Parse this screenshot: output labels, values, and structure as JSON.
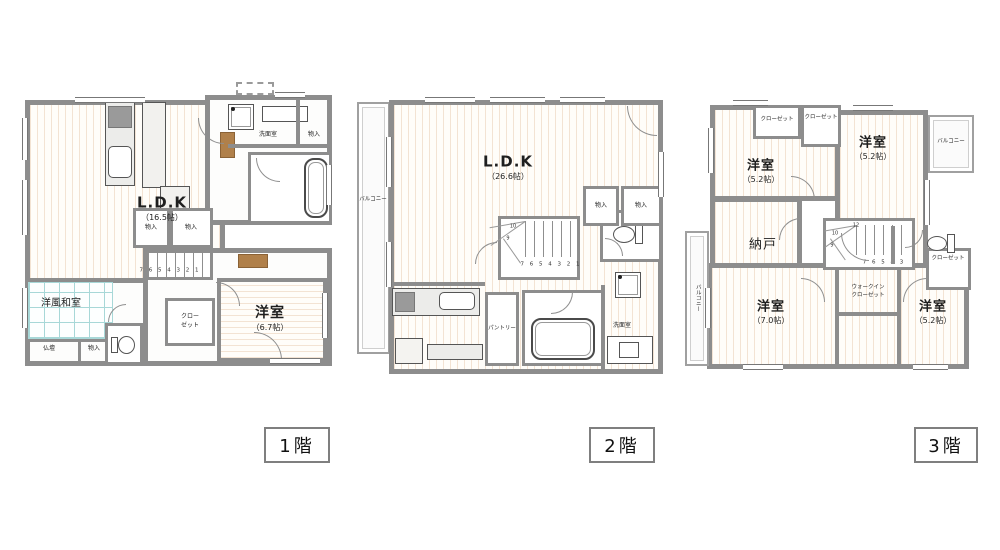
{
  "colors": {
    "wall": "#8d8d8d",
    "floor_line": "#f3e3d3",
    "tatami_line": "#a8d8d8",
    "wood": "#b0804a",
    "fixture": "#555555",
    "balcony_border": "#a0a0a0",
    "text": "#1f1f1f",
    "tag_border": "#7f7f7f"
  },
  "floor1": {
    "tag": "1階",
    "ldk": "L.D.K",
    "ldk_size": "（16.5帖）",
    "storage_a": "物入",
    "storage_b": "物入",
    "storage_c": "物入",
    "storage_d": "物入",
    "washroom": "洗面室",
    "japanese_room": "洋風和室",
    "butsudan": "仏壇",
    "closet_line1": "クロー",
    "closet_line2": "ゼット",
    "bedroom": "洋室",
    "bedroom_size": "（6.7帖）",
    "stairs_run": "7 6 5 4 3 2 1"
  },
  "floor2": {
    "tag": "2階",
    "ldk": "L.D.K",
    "ldk_size": "（26.6帖）",
    "balcony": "バルコニー",
    "storage_a": "物入",
    "storage_b": "物入",
    "pantry": "パントリー",
    "washroom": "洗面室",
    "stairs_run": "7 6 5 4 3 2 1",
    "stairs_n10": "10",
    "stairs_n9": "9"
  },
  "floor3": {
    "tag": "3階",
    "closet_a": "クローゼット",
    "closet_b": "クローゼット",
    "closet_c": "クローゼット",
    "bedroom_a": "洋室",
    "bedroom_a_size": "（5.2帖）",
    "bedroom_b": "洋室",
    "bedroom_b_size": "（5.2帖）",
    "storeroom": "納戸",
    "bedroom_c": "洋室",
    "bedroom_c_size": "（7.0帖）",
    "bedroom_d": "洋室",
    "bedroom_d_size": "（5.2帖）",
    "balcony_left": "バルコニー",
    "balcony_right": "バルコニー",
    "wic_line1": "ウォークイン",
    "wic_line2": "クローゼット",
    "stairs_run": "7 6 5 4 3",
    "stairs_n12": "12",
    "stairs_n10": "10",
    "stairs_n9": "9"
  }
}
